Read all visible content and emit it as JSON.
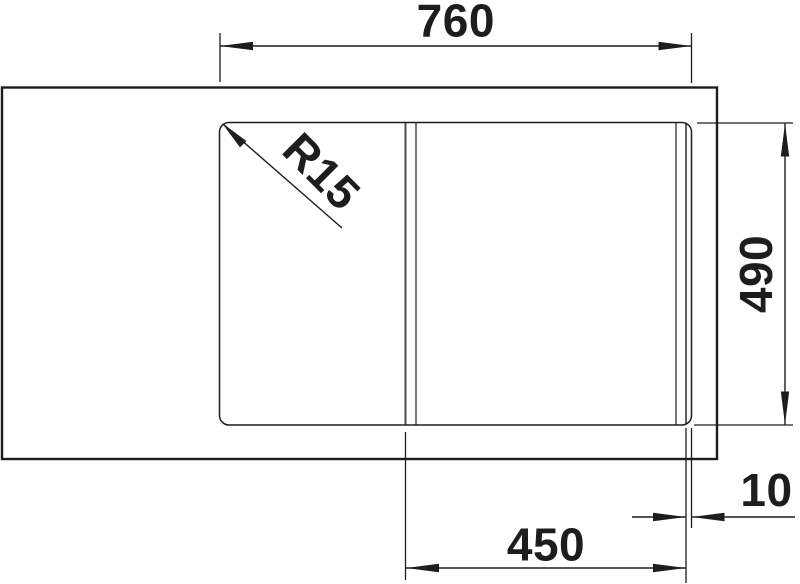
{
  "drawing": {
    "type": "technical-dimension-drawing",
    "subject": "kitchen sink top view with drainboard and bowl",
    "background_color": "#ffffff",
    "line_color": "#1d1d1b",
    "labels": {
      "overall_width": "760",
      "overall_depth": "490",
      "bowl_width": "450",
      "bowl_edge_offset": "10",
      "corner_radius": "R15"
    }
  }
}
